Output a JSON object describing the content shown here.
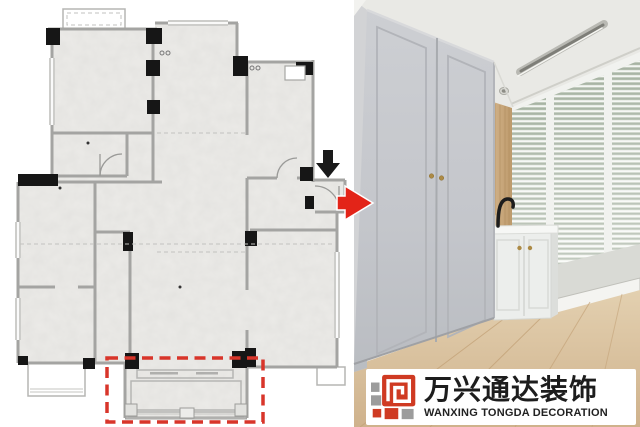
{
  "watermark": {
    "cn": "万兴通达装饰",
    "en": "WANXING TONGDA DECORATION",
    "colors": {
      "red": "#cf3a22",
      "gray": "#9c9c9c",
      "text": "#1d1d1d",
      "background": "#ffffff"
    }
  },
  "floor_plan": {
    "highlight": {
      "color": "#d8352a",
      "style": "dashed"
    },
    "arrows": [
      {
        "name": "down-arrow",
        "direction": "down",
        "color": "#1a1a1a"
      },
      {
        "name": "flow-arrow",
        "direction": "right",
        "color": "#e32418"
      }
    ],
    "colors": {
      "wall": "#a4a4a2",
      "column": "#161616",
      "room_fill": "#ecebe8",
      "background": "#ffffff"
    }
  },
  "photo": {
    "colors": {
      "wardrobe": "#c6c8cc",
      "ceiling": "#e9e9e5",
      "wood_panel": "#cbaa7e",
      "floor": "#d9c2a0",
      "blinds": "#dfe4e0",
      "counter": "#f4f5f3",
      "faucet": "#1d1d1d",
      "knob": "#ac8a45"
    }
  }
}
